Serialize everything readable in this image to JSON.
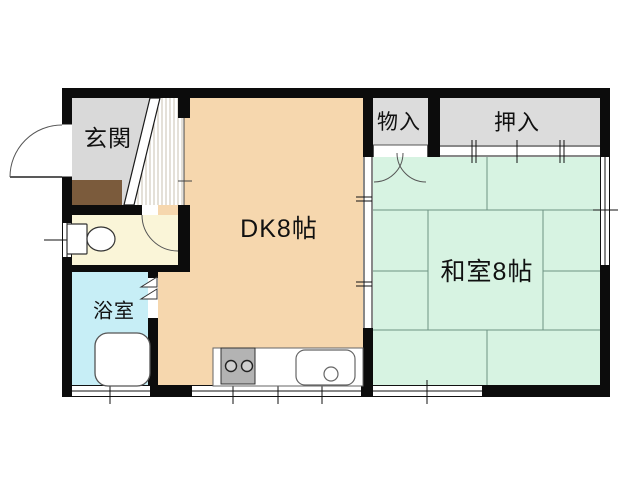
{
  "rooms": {
    "genkan": {
      "label": "玄関"
    },
    "monoire": {
      "label": "物入"
    },
    "oshiire": {
      "label": "押入"
    },
    "dk": {
      "label": "DK8帖"
    },
    "washitsu": {
      "label": "和室8帖"
    },
    "bathroom": {
      "label": "浴室"
    }
  },
  "colors": {
    "wall": "#0c0c0c",
    "genkan_floor": "#d9d9d9",
    "closet_floor": "#dcdcdc",
    "dk_floor": "#f6d7ae",
    "tatami_floor": "#d7f3e2",
    "bathroom_floor": "#c7eef6",
    "toilet_floor": "#faf5d8",
    "entry_step": "#7b5b3c",
    "stove": "#b3b3b3",
    "tatami_line": "#6d9383"
  },
  "fixtures": [
    "toilet-icon",
    "bathtub-icon",
    "stove-icon",
    "sink-icon",
    "entrance-door-icon",
    "folding-door-icon"
  ]
}
